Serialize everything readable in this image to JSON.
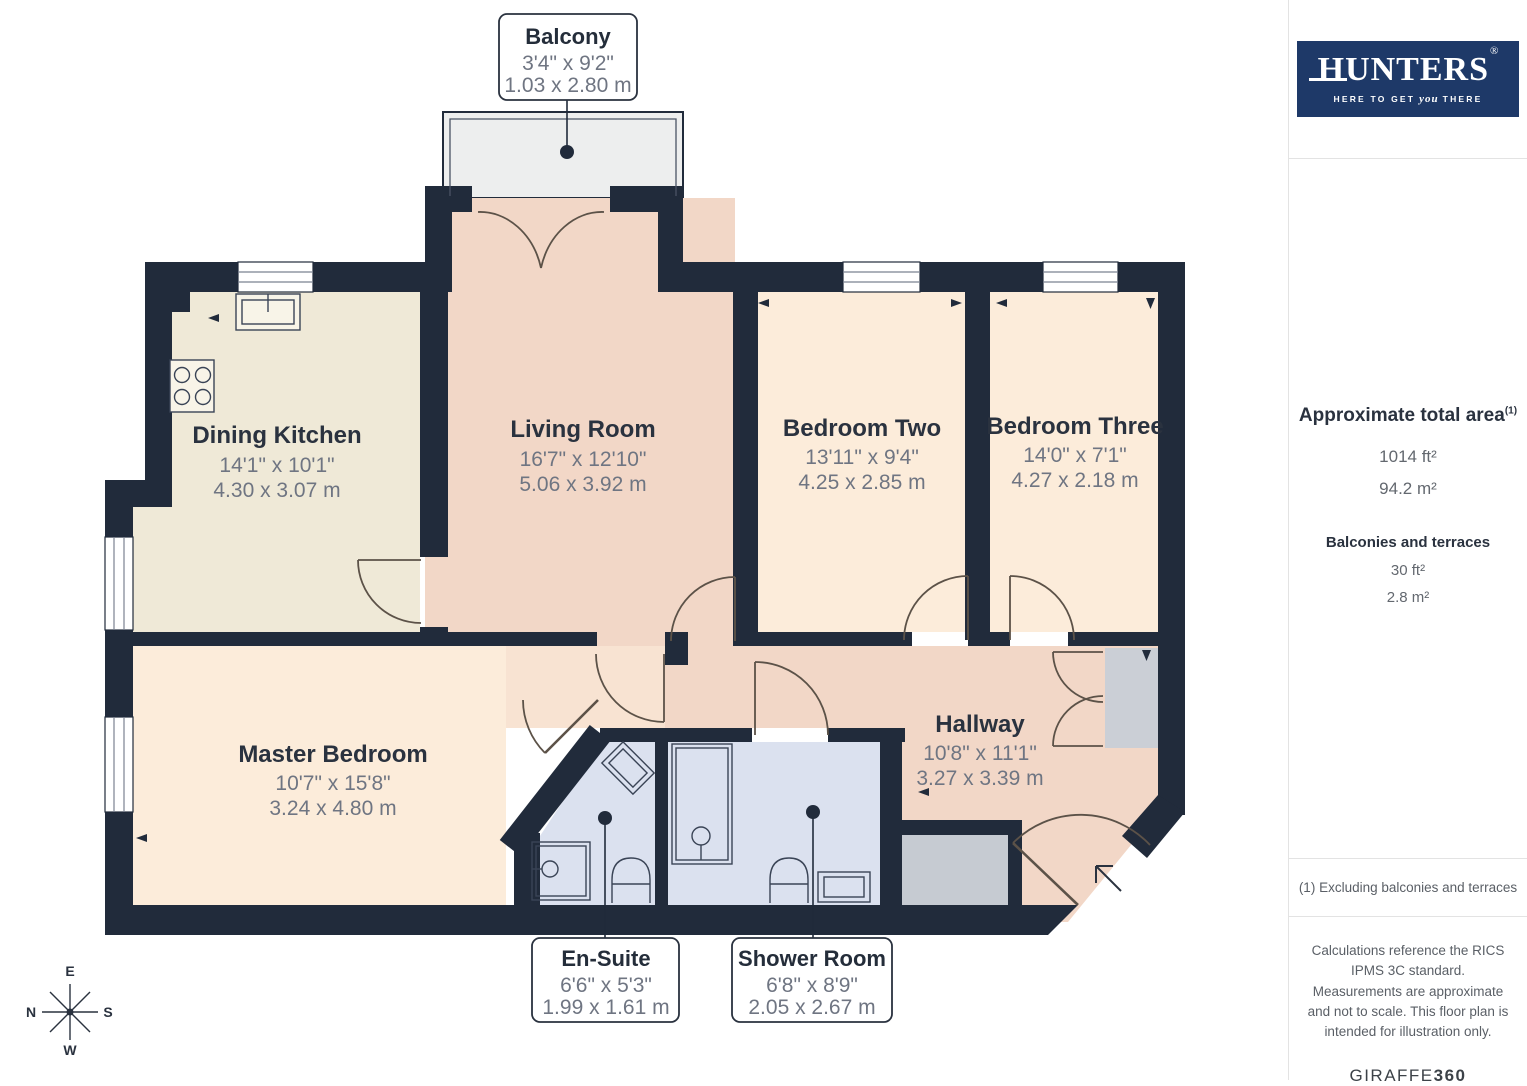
{
  "branding": {
    "logo_text": "HUNTERS",
    "logo_reg": "®",
    "tagline_pre": "HERE TO GET",
    "tagline_emph": "you",
    "tagline_post": "THERE"
  },
  "area_summary": {
    "title": "Approximate total area",
    "title_sup": "(1)",
    "total_ft": "1014 ft²",
    "total_m": "94.2 m²",
    "balconies_label": "Balconies and terraces",
    "balcony_ft": "30 ft²",
    "balcony_m": "2.8 m²"
  },
  "footnote": "(1) Excluding balconies and terraces",
  "disclaimer": "Calculations reference the RICS IPMS 3C standard. Measurements are approximate and not to scale. This floor plan is intended for illustration only.",
  "credit": {
    "brand": "GIRAFFE",
    "suffix": "360"
  },
  "compass": {
    "top": "E",
    "right": "S",
    "bottom": "W",
    "left": "N"
  },
  "rooms": [
    {
      "id": "dining-kitchen",
      "name": "Dining Kitchen",
      "imperial": "14'1\" x 10'1\"",
      "metric": "4.30 x 3.07 m"
    },
    {
      "id": "living-room",
      "name": "Living Room",
      "imperial": "16'7\" x 12'10\"",
      "metric": "5.06 x 3.92 m"
    },
    {
      "id": "bedroom-two",
      "name": "Bedroom Two",
      "imperial": "13'11\" x 9'4\"",
      "metric": "4.25 x 2.85 m"
    },
    {
      "id": "bedroom-three",
      "name": "Bedroom Three",
      "imperial": "14'0\" x 7'1\"",
      "metric": "4.27 x 2.18 m"
    },
    {
      "id": "master-bedroom",
      "name": "Master Bedroom",
      "imperial": "10'7\" x 15'8\"",
      "metric": "3.24 x 4.80 m"
    },
    {
      "id": "hallway",
      "name": "Hallway",
      "imperial": "10'8\" x 11'1\"",
      "metric": "3.27 x 3.39 m"
    },
    {
      "id": "balcony",
      "name": "Balcony",
      "imperial": "3'4\" x 9'2\"",
      "metric": "1.03 x 2.80 m"
    },
    {
      "id": "en-suite",
      "name": "En-Suite",
      "imperial": "6'6\" x 5'3\"",
      "metric": "1.99 x 1.61 m"
    },
    {
      "id": "shower-room",
      "name": "Shower Room",
      "imperial": "6'8\" x 8'9\"",
      "metric": "2.05 x 2.67 m"
    }
  ],
  "palette": {
    "wall": "#212b3b",
    "living_hall_pink": "#f2d7c7",
    "vestibule_peach": "#f8e3d2",
    "bedroom_peach": "#fcecda",
    "kitchen_cream": "#efe9d7",
    "bathroom_blue": "#dbe1ef",
    "balcony_grey": "#edeeee",
    "storage_grey": "#cbcfd6",
    "logo_navy": "#1e3968",
    "label_title": "#2a323f",
    "label_dim": "#6f7582"
  }
}
